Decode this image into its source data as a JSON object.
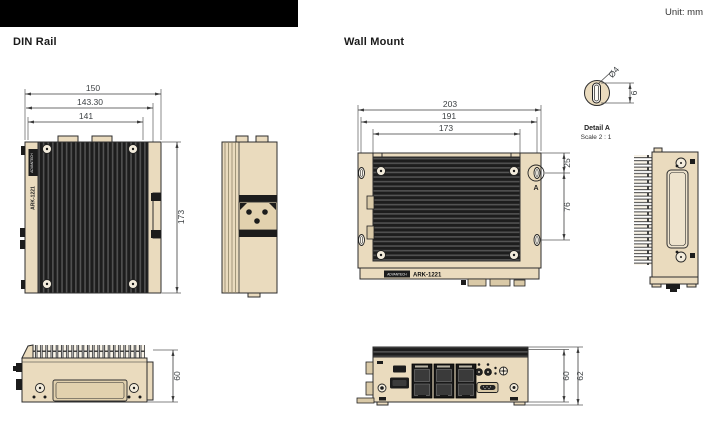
{
  "header": {
    "unit_label": "Unit: mm"
  },
  "sections": {
    "din_rail": {
      "title": "DIN Rail",
      "front_view": {
        "dim_width_outer": "150",
        "dim_width_mid": "143.30",
        "dim_width_inner": "141",
        "dim_height": "173",
        "side_brand_label": "ADVANTECH",
        "side_model_label": "ARK-1221"
      },
      "bottom_view": {
        "dim_height": "60"
      }
    },
    "wall_mount": {
      "title": "Wall Mount",
      "front_view": {
        "dim_width_outer": "203",
        "dim_width_mid": "191",
        "dim_width_inner": "173",
        "dim_mount_hole_offset": "25",
        "dim_mount_hole_span": "76",
        "detail_marker": "A",
        "brand": "ADVANTECH",
        "model": "ARK-1221"
      },
      "detail_a": {
        "title": "Detail A",
        "scale": "Scale 2 : 1",
        "dim_diameter": "Ø4",
        "dim_length": "6"
      },
      "bottom_view": {
        "dim_body_height": "60",
        "dim_overall_height": "62"
      }
    }
  },
  "colors": {
    "beige": "#EADBBE",
    "panel_dark": "#1C1C1C",
    "outline": "#2D2D2D",
    "dim_text": "#3C4043"
  }
}
